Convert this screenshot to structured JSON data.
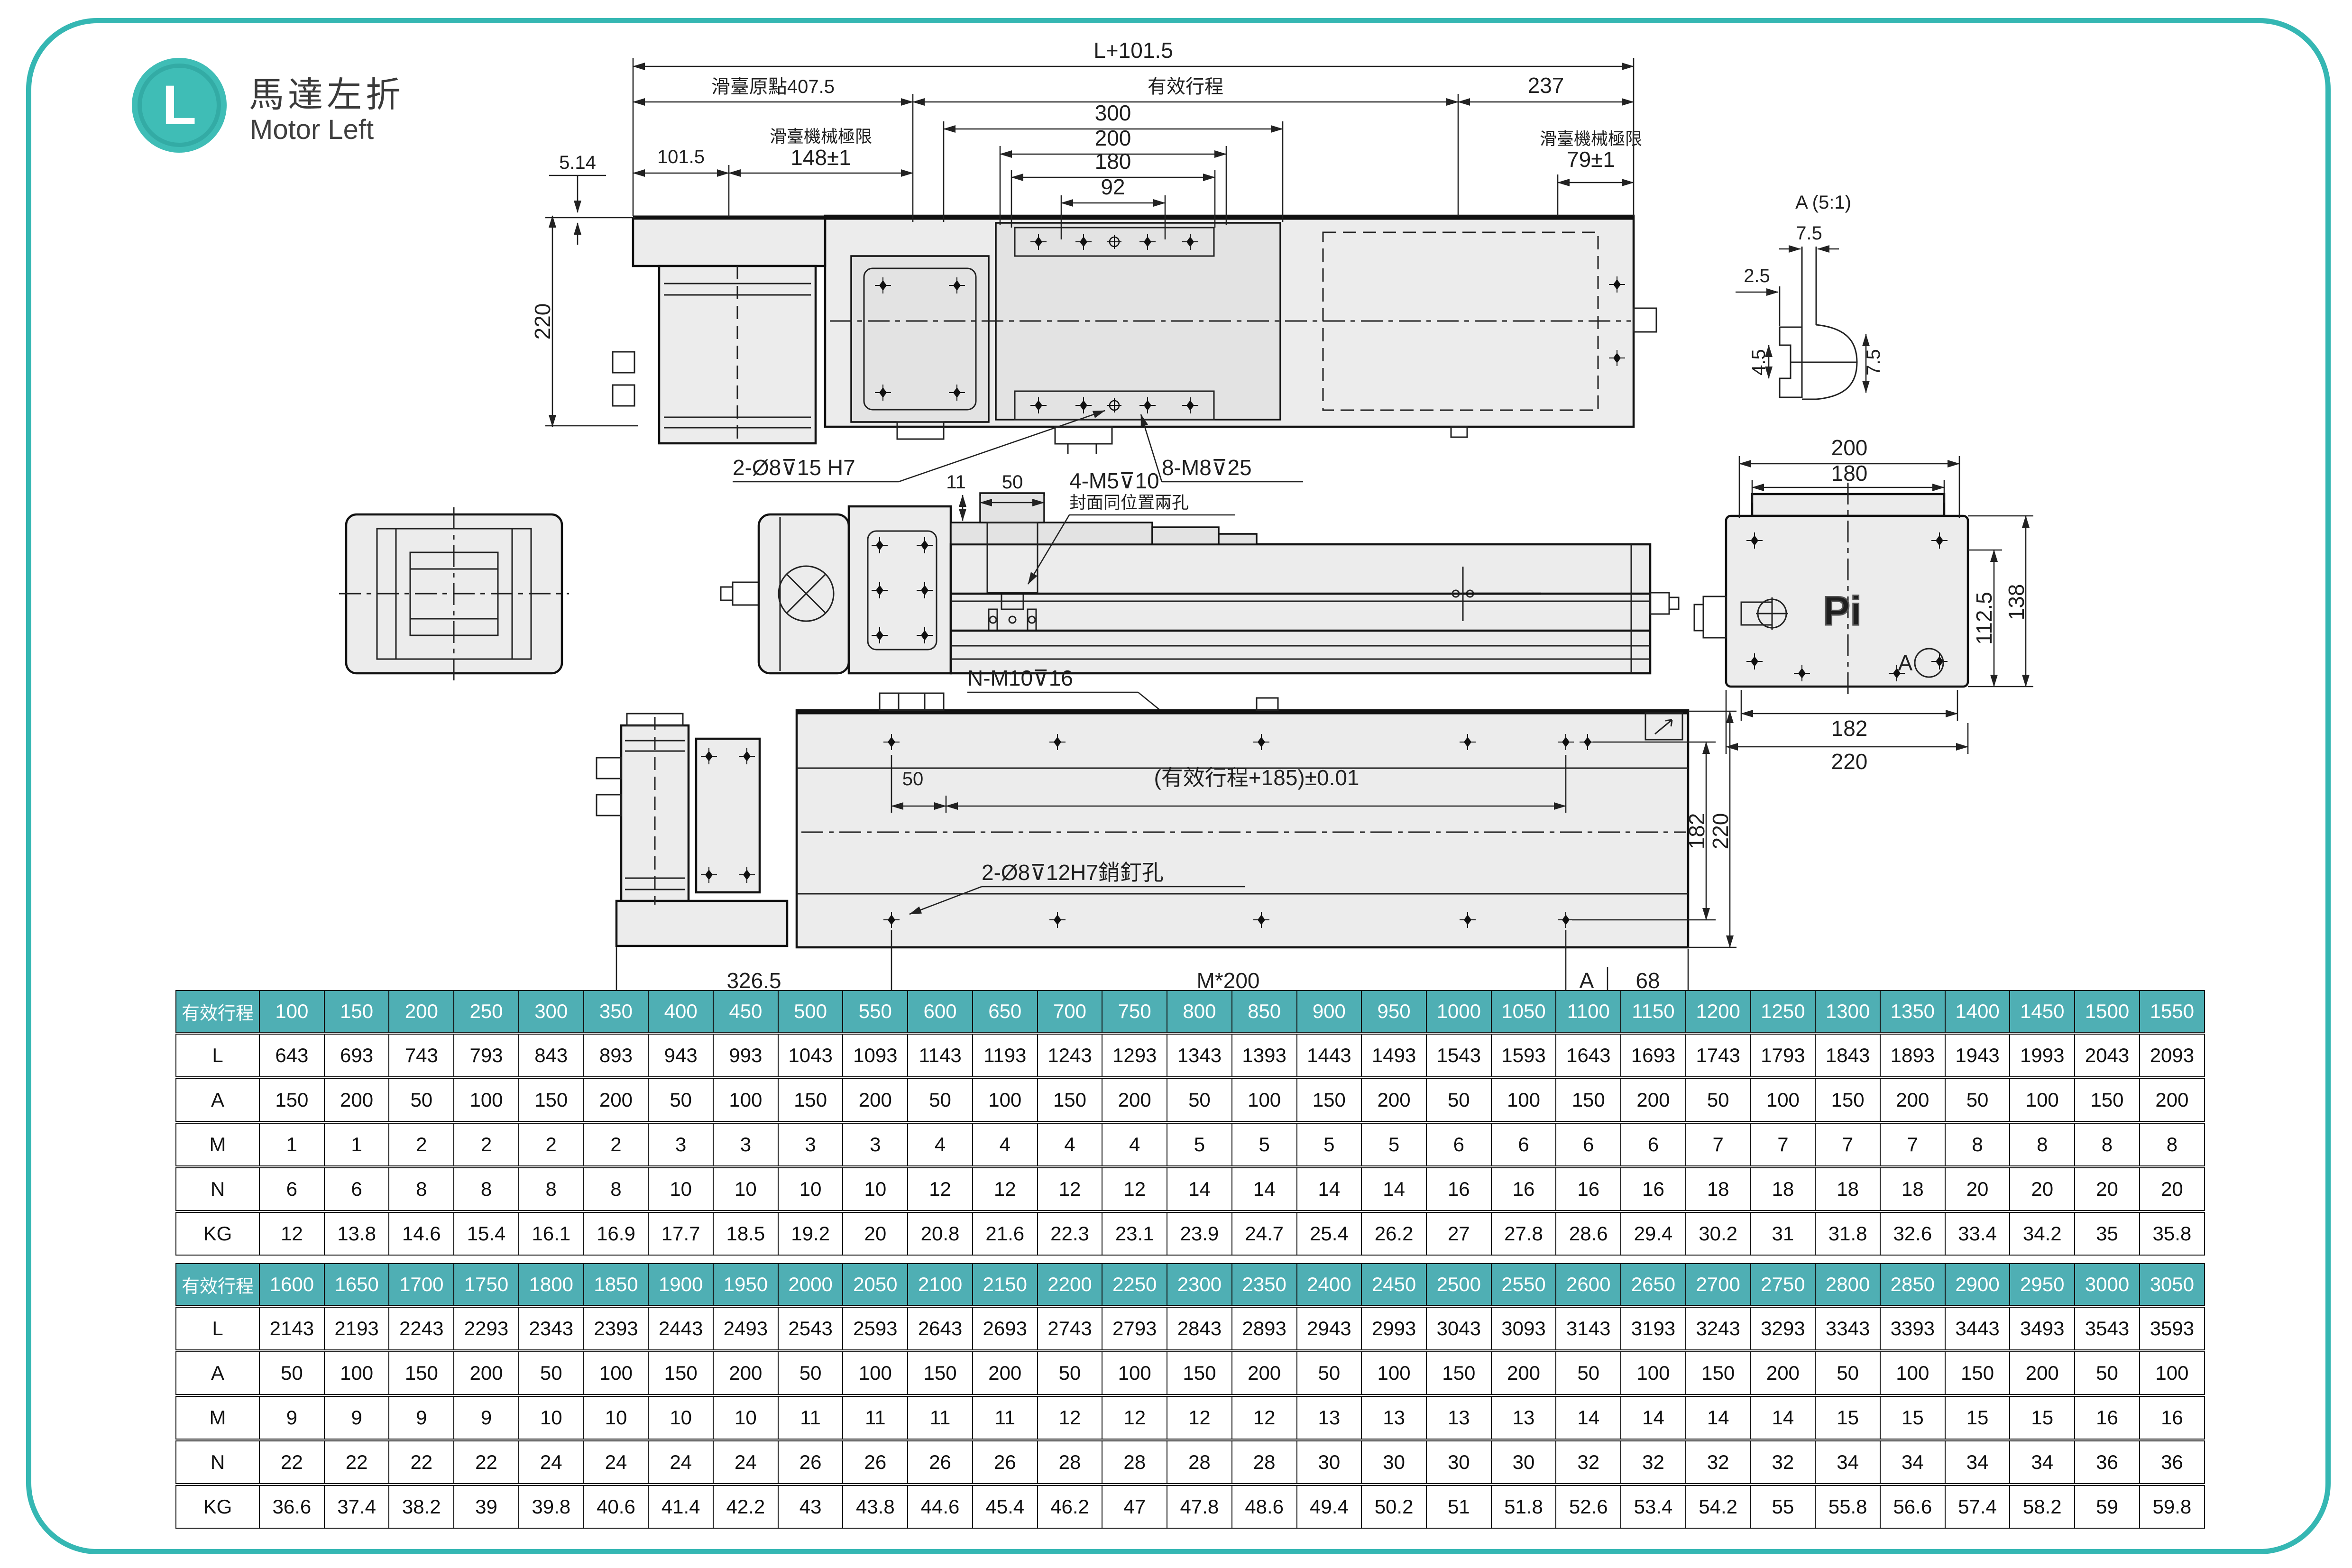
{
  "page": {
    "badge_letter": "L",
    "title_zh": "馬達左折",
    "title_en": "Motor Left"
  },
  "colors": {
    "teal_border": "#35b7b3",
    "badge": "#3fbdb6",
    "table_header": "#4fafb4",
    "drawing_line": "#1c1c1c"
  },
  "drawing": {
    "top_view": {
      "overall": "L+101.5",
      "origin": "滑臺原點407.5",
      "stroke": "有效行程",
      "end": "237",
      "w300": "300",
      "w200": "200",
      "w180": "180",
      "w92": "92",
      "left": "101.5",
      "limit_label_left": "滑臺機械極限",
      "limit_left": "148±1",
      "limit_label_right": "滑臺機械極限",
      "limit_right": "79±1",
      "gap": "5.14",
      "height": "220",
      "pin_holes": "2-Ø8⊽15  H7",
      "screw_holes": "8-M8⊽25"
    },
    "mid_view": {
      "d11": "11",
      "d50": "50",
      "screws": "4-M5⊽10",
      "note": "封面同位置兩孔"
    },
    "end_view": {
      "w200": "200",
      "w180": "180",
      "h112": "112.5",
      "h138": "138",
      "w182": "182",
      "w220": "220",
      "logo": "Pi",
      "detail": "A"
    },
    "bottom_view": {
      "screws": "N-M10⊽16",
      "d50": "50",
      "pitch": "(有效行程+185)±0.01",
      "pins": "2-Ø8⊽12H7銷釘孔",
      "d182": "182",
      "d220": "220",
      "d326": "326.5",
      "m200": "M*200",
      "a": "A",
      "d68": "68"
    },
    "detail_a": {
      "title": "A (5:1)",
      "t75": "7.5",
      "t25": "2.5",
      "l45": "4.5",
      "r75": "7.5"
    }
  },
  "tables": [
    {
      "header_label": "有效行程",
      "columns": [
        "100",
        "150",
        "200",
        "250",
        "300",
        "350",
        "400",
        "450",
        "500",
        "550",
        "600",
        "650",
        "700",
        "750",
        "800",
        "850",
        "900",
        "950",
        "1000",
        "1050",
        "1100",
        "1150",
        "1200",
        "1250",
        "1300",
        "1350",
        "1400",
        "1450",
        "1500",
        "1550"
      ],
      "rows": [
        {
          "label": "L",
          "values": [
            "643",
            "693",
            "743",
            "793",
            "843",
            "893",
            "943",
            "993",
            "1043",
            "1093",
            "1143",
            "1193",
            "1243",
            "1293",
            "1343",
            "1393",
            "1443",
            "1493",
            "1543",
            "1593",
            "1643",
            "1693",
            "1743",
            "1793",
            "1843",
            "1893",
            "1943",
            "1993",
            "2043",
            "2093"
          ]
        },
        {
          "label": "A",
          "values": [
            "150",
            "200",
            "50",
            "100",
            "150",
            "200",
            "50",
            "100",
            "150",
            "200",
            "50",
            "100",
            "150",
            "200",
            "50",
            "100",
            "150",
            "200",
            "50",
            "100",
            "150",
            "200",
            "50",
            "100",
            "150",
            "200",
            "50",
            "100",
            "150",
            "200"
          ]
        },
        {
          "label": "M",
          "values": [
            "1",
            "1",
            "2",
            "2",
            "2",
            "2",
            "3",
            "3",
            "3",
            "3",
            "4",
            "4",
            "4",
            "4",
            "5",
            "5",
            "5",
            "5",
            "6",
            "6",
            "6",
            "6",
            "7",
            "7",
            "7",
            "7",
            "8",
            "8",
            "8",
            "8"
          ]
        },
        {
          "label": "N",
          "values": [
            "6",
            "6",
            "8",
            "8",
            "8",
            "8",
            "10",
            "10",
            "10",
            "10",
            "12",
            "12",
            "12",
            "12",
            "14",
            "14",
            "14",
            "14",
            "16",
            "16",
            "16",
            "16",
            "18",
            "18",
            "18",
            "18",
            "20",
            "20",
            "20",
            "20"
          ]
        },
        {
          "label": "KG",
          "values": [
            "12",
            "13.8",
            "14.6",
            "15.4",
            "16.1",
            "16.9",
            "17.7",
            "18.5",
            "19.2",
            "20",
            "20.8",
            "21.6",
            "22.3",
            "23.1",
            "23.9",
            "24.7",
            "25.4",
            "26.2",
            "27",
            "27.8",
            "28.6",
            "29.4",
            "30.2",
            "31",
            "31.8",
            "32.6",
            "33.4",
            "34.2",
            "35",
            "35.8"
          ]
        }
      ]
    },
    {
      "header_label": "有效行程",
      "columns": [
        "1600",
        "1650",
        "1700",
        "1750",
        "1800",
        "1850",
        "1900",
        "1950",
        "2000",
        "2050",
        "2100",
        "2150",
        "2200",
        "2250",
        "2300",
        "2350",
        "2400",
        "2450",
        "2500",
        "2550",
        "2600",
        "2650",
        "2700",
        "2750",
        "2800",
        "2850",
        "2900",
        "2950",
        "3000",
        "3050"
      ],
      "rows": [
        {
          "label": "L",
          "values": [
            "2143",
            "2193",
            "2243",
            "2293",
            "2343",
            "2393",
            "2443",
            "2493",
            "2543",
            "2593",
            "2643",
            "2693",
            "2743",
            "2793",
            "2843",
            "2893",
            "2943",
            "2993",
            "3043",
            "3093",
            "3143",
            "3193",
            "3243",
            "3293",
            "3343",
            "3393",
            "3443",
            "3493",
            "3543",
            "3593"
          ]
        },
        {
          "label": "A",
          "values": [
            "50",
            "100",
            "150",
            "200",
            "50",
            "100",
            "150",
            "200",
            "50",
            "100",
            "150",
            "200",
            "50",
            "100",
            "150",
            "200",
            "50",
            "100",
            "150",
            "200",
            "50",
            "100",
            "150",
            "200",
            "50",
            "100",
            "150",
            "200",
            "50",
            "100"
          ]
        },
        {
          "label": "M",
          "values": [
            "9",
            "9",
            "9",
            "9",
            "10",
            "10",
            "10",
            "10",
            "11",
            "11",
            "11",
            "11",
            "12",
            "12",
            "12",
            "12",
            "13",
            "13",
            "13",
            "13",
            "14",
            "14",
            "14",
            "14",
            "15",
            "15",
            "15",
            "15",
            "16",
            "16"
          ]
        },
        {
          "label": "N",
          "values": [
            "22",
            "22",
            "22",
            "22",
            "24",
            "24",
            "24",
            "24",
            "26",
            "26",
            "26",
            "26",
            "28",
            "28",
            "28",
            "28",
            "30",
            "30",
            "30",
            "30",
            "32",
            "32",
            "32",
            "32",
            "34",
            "34",
            "34",
            "34",
            "36",
            "36"
          ]
        },
        {
          "label": "KG",
          "values": [
            "36.6",
            "37.4",
            "38.2",
            "39",
            "39.8",
            "40.6",
            "41.4",
            "42.2",
            "43",
            "43.8",
            "44.6",
            "45.4",
            "46.2",
            "47",
            "47.8",
            "48.6",
            "49.4",
            "50.2",
            "51",
            "51.8",
            "52.6",
            "53.4",
            "54.2",
            "55",
            "55.8",
            "56.6",
            "57.4",
            "58.2",
            "59",
            "59.8"
          ]
        }
      ]
    }
  ]
}
